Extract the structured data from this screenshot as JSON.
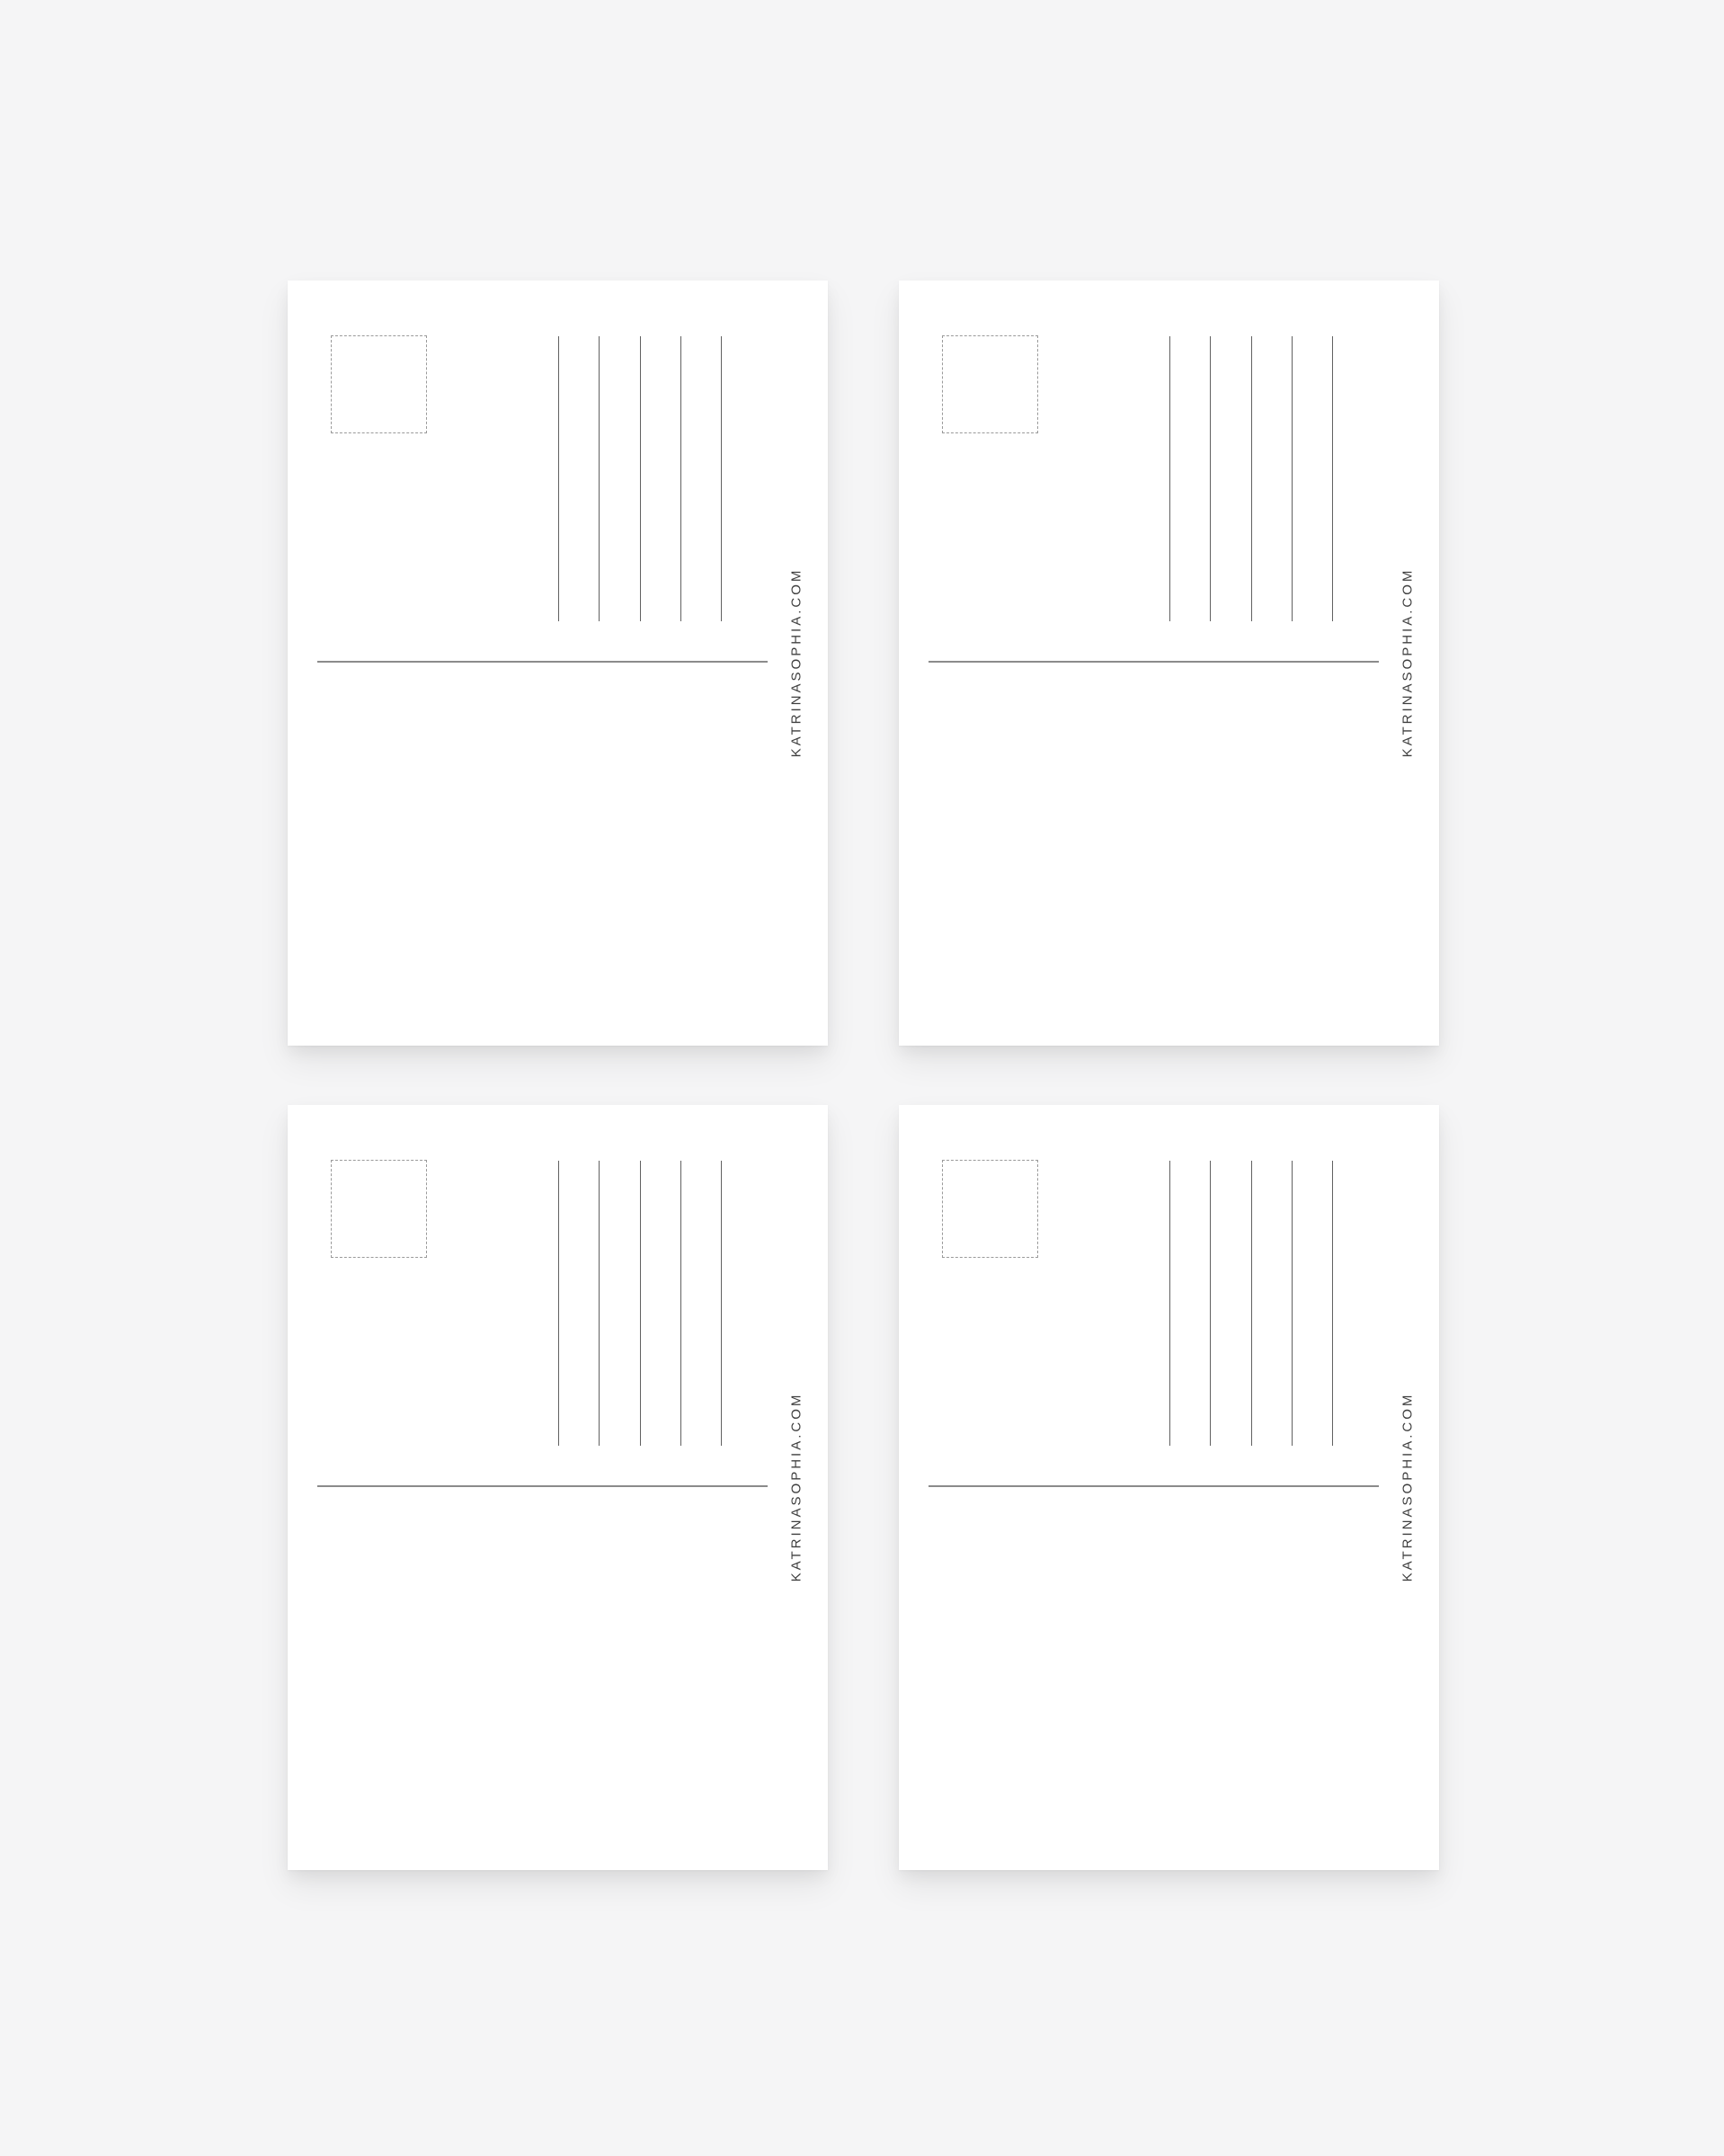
{
  "page": {
    "background_color": "#f5f5f6"
  },
  "brand": {
    "website_label": "KATRINASOPHIA.COM",
    "text_color": "#3f3f3f"
  },
  "postcards": {
    "count": 4,
    "card_color": "#ffffff",
    "stamp_box": {
      "border_color": "#9a9a9a",
      "border_style": "dashed"
    },
    "address_lines": {
      "count_per_card": 5,
      "color": "#616161"
    },
    "divider_line": {
      "color": "#8b8b8b"
    }
  }
}
